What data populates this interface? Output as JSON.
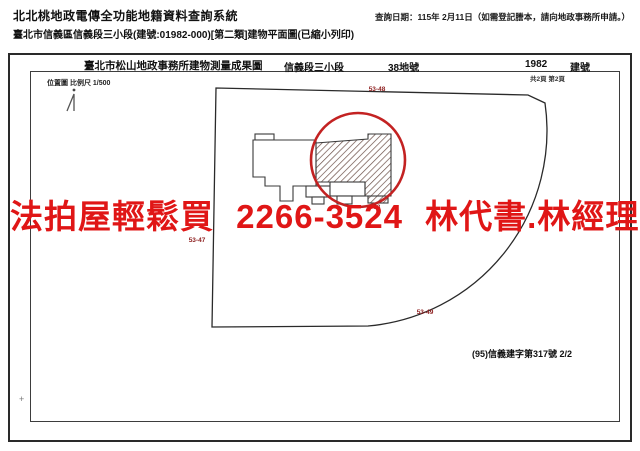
{
  "header": {
    "system_title": "北北桃地政電傳全功能地籍資料查詢系統",
    "query_date": "查詢日期：115年 2月11日（如需登記謄本，請向地政事務所申請。）",
    "document_title": "臺北市信義區信義段三小段(建號:01982-000)[第二類]建物平面圖(已縮小列印)"
  },
  "sheet": {
    "office_title": "臺北市松山地政事務所建物測量成果圖",
    "section_name": "信義段三小段",
    "lot_number": "38地號",
    "building_number": "1982",
    "building_number_label": "建號",
    "page_info": "共2頁 第2頁",
    "location_scale": "位置圖 比例尺 1/500",
    "certificate_number": "(95)信義建字第317號 2/2",
    "registration_mark": "+"
  },
  "map_labels": {
    "parcel_top": "53-48",
    "parcel_left": "53-47",
    "parcel_bottom": "53-49",
    "building_lot": "38"
  },
  "watermark": {
    "text": "法拍屋輕鬆買 2266-3524 林代書.林經理",
    "color": "#e01616"
  },
  "colors": {
    "annotation_red": "#8c1c1c",
    "circle_red": "#c32222",
    "line_black": "#2a2a2a",
    "hatch_brown": "#6b4f47"
  }
}
